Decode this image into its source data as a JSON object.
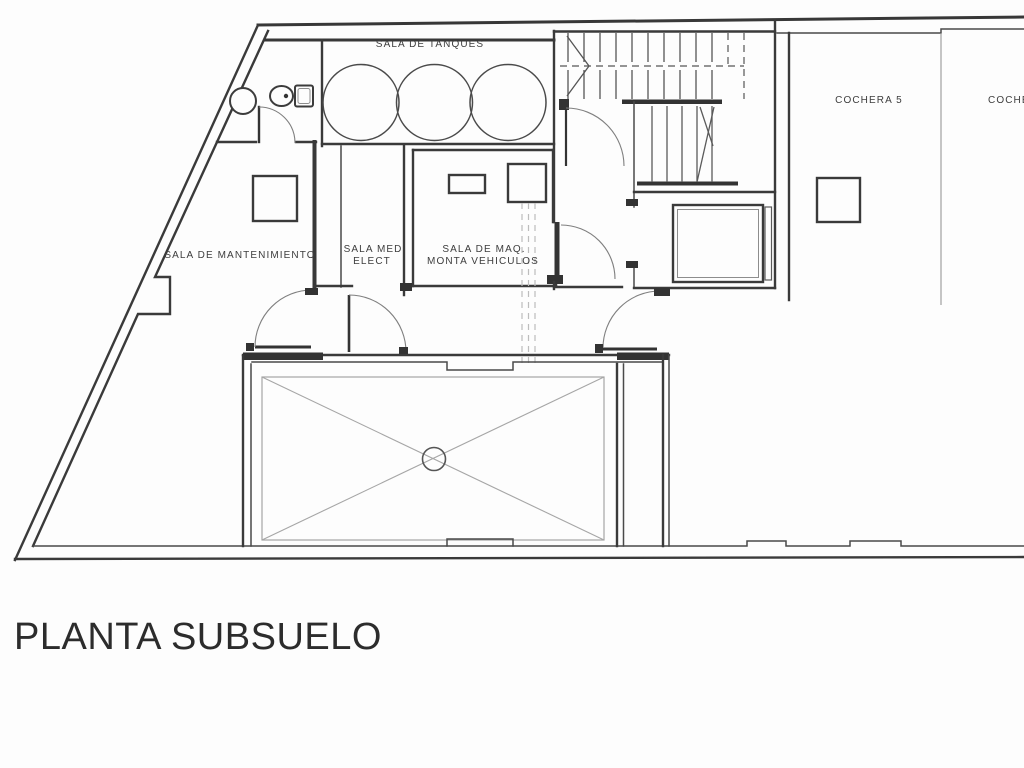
{
  "title": {
    "text": "PLANTA SUBSUELO"
  },
  "plan": {
    "labels": {
      "tanques": "SALA DE TANQUES",
      "mantenimiento": "SALA DE MANTENIMIENTO",
      "med_elect_1": "SALA MED.",
      "med_elect_2": "ELECT",
      "maq_1": "SALA DE MAQ.",
      "maq_2": "MONTA VEHICULOS",
      "cochera5": "COCHERA 5",
      "cochera_next": "COCHERA"
    },
    "colors": {
      "background": "#fdfdfd",
      "wall": "#3a3a3a",
      "light_line": "#a6a6a6"
    }
  }
}
